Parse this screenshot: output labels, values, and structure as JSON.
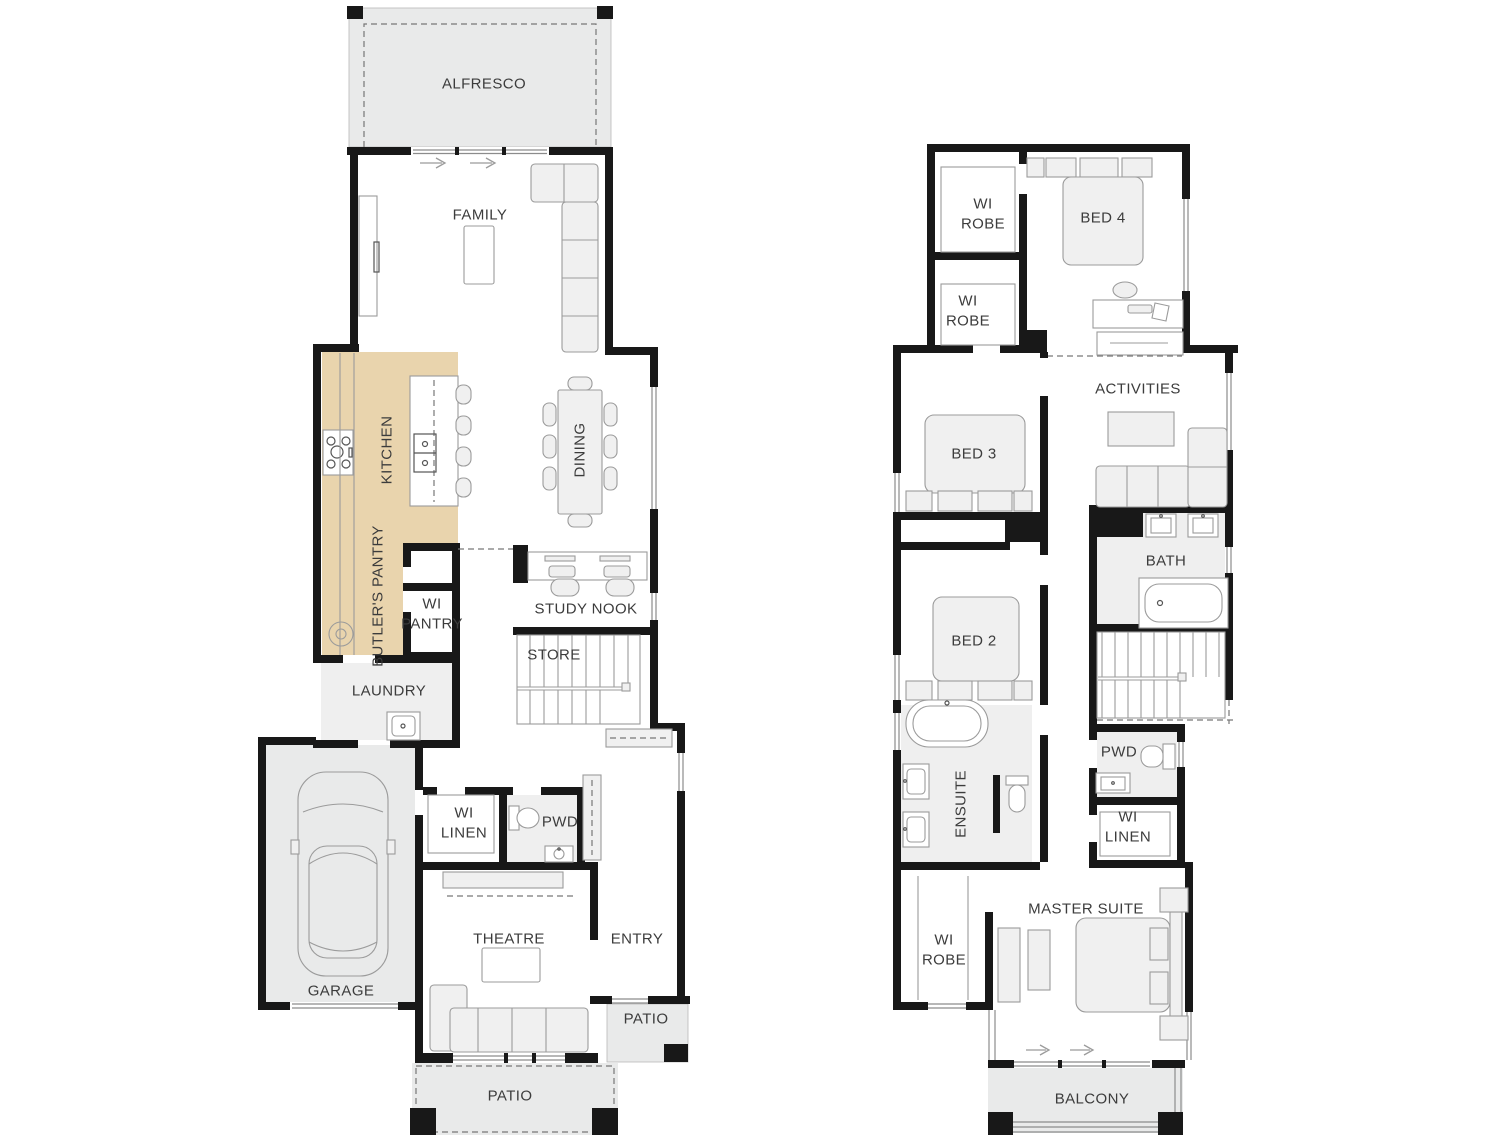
{
  "colors": {
    "highlight_room": "#e9d4ad",
    "wall": "#181818",
    "outdoor_fill": "#e9eaea",
    "tile_fill": "#efefef",
    "furniture_fill": "#f0f0f0",
    "label_text": "#3c3c3c"
  },
  "icons": {
    "sliding_door_arrow": "→"
  },
  "ground": {
    "alfresco": "ALFRESCO",
    "family": "FAMILY",
    "kitchen": "KITCHEN",
    "dining": "DINING",
    "butlers_pantry": "BUTLER'S PANTRY",
    "wi_pantry": "WI\nPANTRY",
    "study_nook": "STUDY NOOK",
    "store": "STORE",
    "laundry": "LAUNDRY",
    "garage": "GARAGE",
    "wi_linen": "WI\nLINEN",
    "pwd": "PWD",
    "theatre": "THEATRE",
    "entry": "ENTRY",
    "patio_side": "PATIO",
    "patio_rear": "PATIO"
  },
  "upper": {
    "wi_robe_bed4": "WI\nROBE",
    "bed4": "BED 4",
    "wi_robe_hall": "WI\nROBE",
    "bed3": "BED 3",
    "activities": "ACTIVITIES",
    "bath": "BATH",
    "bed2": "BED 2",
    "ensuite": "ENSUITE",
    "pwd": "PWD",
    "wi_linen": "WI\nLINEN",
    "master_suite": "MASTER SUITE",
    "wi_robe_master": "WI\nROBE",
    "balcony": "BALCONY"
  }
}
